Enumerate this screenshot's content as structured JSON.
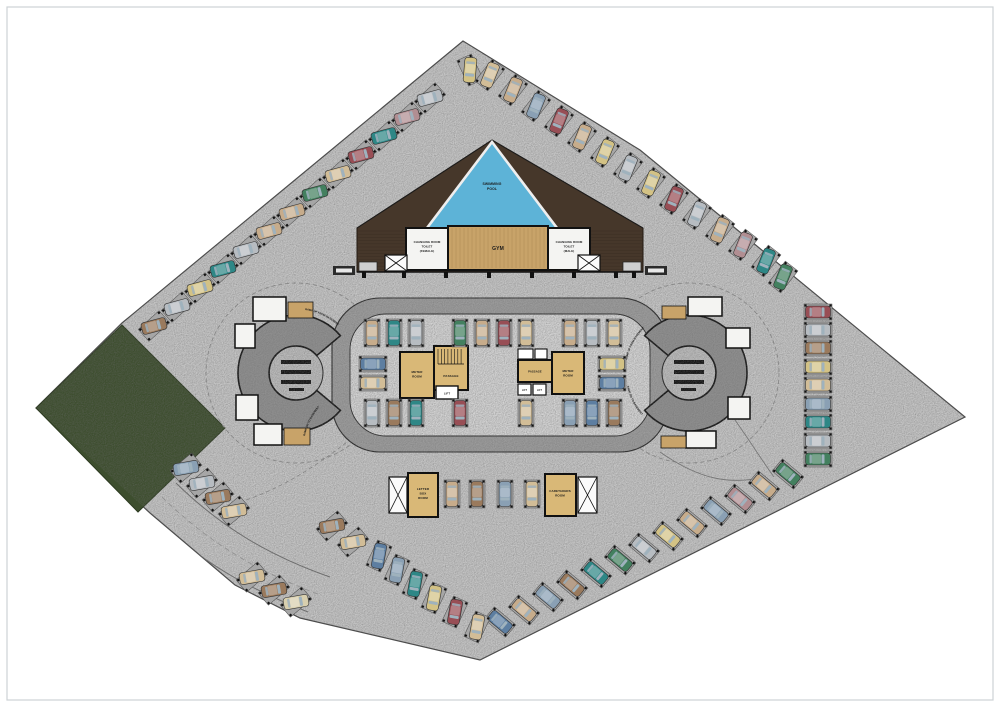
{
  "page": {
    "background": "#ffffff",
    "frame_color": "#cdd2d6"
  },
  "plan": {
    "labels": {
      "pool": [
        "SWIMMING",
        "POOL"
      ],
      "gym": "GYM",
      "changing_female": [
        "CHANGING ROOM",
        "TOILET",
        "(FEMALE)"
      ],
      "changing_male": [
        "CHANGING ROOM",
        "TOILET",
        "(MALE)"
      ],
      "meter": [
        "METER",
        "ROOM"
      ],
      "passage": "PASSAGE",
      "lift": "LIFT",
      "letter_box": [
        "LETTER",
        "BOX",
        "ROOM"
      ],
      "caretakers": [
        "CARETAKERS",
        "ROOM"
      ],
      "ramp_up": "RAMP UP FROM BASEMENT",
      "ramp_dn": "RAMP DN TO BASEMENT"
    },
    "colors": {
      "paving": "#c6c6c6",
      "road": "#9c9c9c",
      "island": "#d4d4d4",
      "ramp": "#8f8f8f",
      "ramp_core": "#bcbcbc",
      "lawn": "#3d4e2e",
      "pool": "#5db3d7",
      "wood": "#46372a",
      "gym_floor": "#c8a369",
      "core_floor": "#d9b877",
      "room_white": "#f4f4f2",
      "stall": "#a6a6a6",
      "wall": "#111111"
    },
    "car_palette": {
      "be": "#c7ac8b",
      "sa": "#d2bd97",
      "si": "#b7bcc1",
      "gy": "#9aa1a7",
      "te": "#2e8786",
      "gr": "#43805f",
      "ye": "#d3c285",
      "ma": "#984e55",
      "mv": "#b18e92",
      "br": "#9a7a5d",
      "st": "#8aa0b4",
      "nv": "#5d7ea1",
      "cr": "#d8cfae",
      "wh": "#dcdcda"
    },
    "cars": [
      {
        "x": 470,
        "y": 70,
        "a": 95,
        "p": 65,
        "c": "ye"
      },
      {
        "x": 430,
        "y": 98,
        "a": -15,
        "p": -42,
        "c": "si"
      },
      {
        "x": 407,
        "y": 117,
        "a": -15,
        "p": -42,
        "c": "mv"
      },
      {
        "x": 384,
        "y": 136,
        "a": -15,
        "p": -42,
        "c": "te"
      },
      {
        "x": 361,
        "y": 155,
        "a": -15,
        "p": -42,
        "c": "ma"
      },
      {
        "x": 338,
        "y": 174,
        "a": -15,
        "p": -42,
        "c": "sa"
      },
      {
        "x": 315,
        "y": 193,
        "a": -15,
        "p": -42,
        "c": "gr"
      },
      {
        "x": 292,
        "y": 212,
        "a": -15,
        "p": -42,
        "c": "be"
      },
      {
        "x": 269,
        "y": 231,
        "a": -15,
        "p": -42,
        "c": "be"
      },
      {
        "x": 246,
        "y": 250,
        "a": -15,
        "p": -42,
        "c": "si"
      },
      {
        "x": 223,
        "y": 269,
        "a": -15,
        "p": -42,
        "c": "te"
      },
      {
        "x": 200,
        "y": 288,
        "a": -15,
        "p": -42,
        "c": "ye"
      },
      {
        "x": 177,
        "y": 307,
        "a": -15,
        "p": -42,
        "c": "si"
      },
      {
        "x": 154,
        "y": 326,
        "a": -15,
        "p": -42,
        "c": "br"
      },
      {
        "x": 490,
        "y": 75,
        "a": 112,
        "p": 128,
        "c": "sa"
      },
      {
        "x": 513,
        "y": 90,
        "a": 112,
        "p": 128,
        "c": "be"
      },
      {
        "x": 536,
        "y": 106,
        "a": 112,
        "p": 128,
        "c": "st"
      },
      {
        "x": 559,
        "y": 121,
        "a": 112,
        "p": 128,
        "c": "ma"
      },
      {
        "x": 582,
        "y": 137,
        "a": 112,
        "p": 128,
        "c": "be"
      },
      {
        "x": 605,
        "y": 152,
        "a": 112,
        "p": 128,
        "c": "ye"
      },
      {
        "x": 628,
        "y": 168,
        "a": 112,
        "p": 128,
        "c": "si"
      },
      {
        "x": 651,
        "y": 183,
        "a": 112,
        "p": 128,
        "c": "ye"
      },
      {
        "x": 674,
        "y": 199,
        "a": 112,
        "p": 128,
        "c": "ma"
      },
      {
        "x": 697,
        "y": 214,
        "a": 112,
        "p": 128,
        "c": "si"
      },
      {
        "x": 720,
        "y": 230,
        "a": 112,
        "p": 128,
        "c": "be"
      },
      {
        "x": 743,
        "y": 245,
        "a": 112,
        "p": 128,
        "c": "mv"
      },
      {
        "x": 766,
        "y": 261,
        "a": 112,
        "p": 128,
        "c": "te"
      },
      {
        "x": 783,
        "y": 277,
        "a": 112,
        "p": 128,
        "c": "gr"
      },
      {
        "x": 818,
        "y": 312,
        "a": 0,
        "p": 0,
        "c": "ma"
      },
      {
        "x": 818,
        "y": 330,
        "a": 0,
        "p": 0,
        "c": "si"
      },
      {
        "x": 818,
        "y": 348,
        "a": 0,
        "p": 0,
        "c": "br"
      },
      {
        "x": 818,
        "y": 367,
        "a": 0,
        "p": 0,
        "c": "ye"
      },
      {
        "x": 818,
        "y": 385,
        "a": 0,
        "p": 0,
        "c": "sa"
      },
      {
        "x": 818,
        "y": 404,
        "a": 0,
        "p": 0,
        "c": "st"
      },
      {
        "x": 818,
        "y": 422,
        "a": 0,
        "p": 0,
        "c": "te"
      },
      {
        "x": 818,
        "y": 441,
        "a": 0,
        "p": 0,
        "c": "si"
      },
      {
        "x": 818,
        "y": 459,
        "a": 0,
        "p": 0,
        "c": "gr"
      },
      {
        "x": 500,
        "y": 622,
        "a": 40,
        "p": 40,
        "c": "nv"
      },
      {
        "x": 524,
        "y": 610,
        "a": 40,
        "p": 40,
        "c": "be"
      },
      {
        "x": 548,
        "y": 597,
        "a": 40,
        "p": 40,
        "c": "st"
      },
      {
        "x": 572,
        "y": 585,
        "a": 40,
        "p": 40,
        "c": "br"
      },
      {
        "x": 596,
        "y": 573,
        "a": 40,
        "p": 40,
        "c": "te"
      },
      {
        "x": 620,
        "y": 560,
        "a": 40,
        "p": 40,
        "c": "gr"
      },
      {
        "x": 644,
        "y": 548,
        "a": 40,
        "p": 40,
        "c": "si"
      },
      {
        "x": 668,
        "y": 536,
        "a": 40,
        "p": 40,
        "c": "ye"
      },
      {
        "x": 692,
        "y": 523,
        "a": 40,
        "p": 40,
        "c": "be"
      },
      {
        "x": 716,
        "y": 511,
        "a": 40,
        "p": 40,
        "c": "st"
      },
      {
        "x": 740,
        "y": 499,
        "a": 40,
        "p": 40,
        "c": "mv"
      },
      {
        "x": 764,
        "y": 486,
        "a": 40,
        "p": 40,
        "c": "be"
      },
      {
        "x": 788,
        "y": 474,
        "a": 40,
        "p": 40,
        "c": "gr"
      },
      {
        "x": 379,
        "y": 556,
        "a": 100,
        "p": 115,
        "c": "nv"
      },
      {
        "x": 397,
        "y": 570,
        "a": 100,
        "p": 115,
        "c": "st"
      },
      {
        "x": 415,
        "y": 584,
        "a": 100,
        "p": 115,
        "c": "te"
      },
      {
        "x": 434,
        "y": 598,
        "a": 100,
        "p": 115,
        "c": "ye"
      },
      {
        "x": 455,
        "y": 612,
        "a": 100,
        "p": 115,
        "c": "ma"
      },
      {
        "x": 477,
        "y": 627,
        "a": 100,
        "p": 115,
        "c": "sa"
      },
      {
        "x": 252,
        "y": 577,
        "a": -10,
        "p": -40,
        "c": "sa"
      },
      {
        "x": 274,
        "y": 590,
        "a": -10,
        "p": -40,
        "c": "br"
      },
      {
        "x": 296,
        "y": 602,
        "a": -10,
        "p": -40,
        "c": "cr"
      },
      {
        "x": 332,
        "y": 526,
        "a": -10,
        "p": -40,
        "c": "br"
      },
      {
        "x": 353,
        "y": 542,
        "a": -10,
        "p": -40,
        "c": "sa"
      },
      {
        "x": 186,
        "y": 468,
        "a": -10,
        "p": -40,
        "c": "st"
      },
      {
        "x": 202,
        "y": 483,
        "a": -10,
        "p": -40,
        "c": "si"
      },
      {
        "x": 218,
        "y": 497,
        "a": -10,
        "p": -40,
        "c": "br"
      },
      {
        "x": 234,
        "y": 511,
        "a": -10,
        "p": -40,
        "c": "sa"
      },
      {
        "x": 372,
        "y": 333,
        "a": 90,
        "p": 90,
        "c": "be"
      },
      {
        "x": 394,
        "y": 333,
        "a": 90,
        "p": 90,
        "c": "te"
      },
      {
        "x": 416,
        "y": 333,
        "a": 90,
        "p": 90,
        "c": "si"
      },
      {
        "x": 460,
        "y": 333,
        "a": 90,
        "p": 90,
        "c": "gr"
      },
      {
        "x": 482,
        "y": 333,
        "a": 90,
        "p": 90,
        "c": "be"
      },
      {
        "x": 504,
        "y": 333,
        "a": 90,
        "p": 90,
        "c": "ma"
      },
      {
        "x": 526,
        "y": 333,
        "a": 90,
        "p": 90,
        "c": "sa"
      },
      {
        "x": 570,
        "y": 333,
        "a": 90,
        "p": 90,
        "c": "be"
      },
      {
        "x": 592,
        "y": 333,
        "a": 90,
        "p": 90,
        "c": "si"
      },
      {
        "x": 614,
        "y": 333,
        "a": 90,
        "p": 90,
        "c": "sa"
      },
      {
        "x": 372,
        "y": 413,
        "a": 90,
        "p": 90,
        "c": "si"
      },
      {
        "x": 394,
        "y": 413,
        "a": 90,
        "p": 90,
        "c": "br"
      },
      {
        "x": 416,
        "y": 413,
        "a": 90,
        "p": 90,
        "c": "te"
      },
      {
        "x": 460,
        "y": 413,
        "a": 90,
        "p": 90,
        "c": "ma"
      },
      {
        "x": 526,
        "y": 413,
        "a": 90,
        "p": 90,
        "c": "sa"
      },
      {
        "x": 570,
        "y": 413,
        "a": 90,
        "p": 90,
        "c": "st"
      },
      {
        "x": 592,
        "y": 413,
        "a": 90,
        "p": 90,
        "c": "nv"
      },
      {
        "x": 614,
        "y": 413,
        "a": 90,
        "p": 90,
        "c": "br"
      },
      {
        "x": 373,
        "y": 364,
        "a": 0,
        "p": 0,
        "c": "nv"
      },
      {
        "x": 373,
        "y": 383,
        "a": 0,
        "p": 0,
        "c": "sa"
      },
      {
        "x": 612,
        "y": 364,
        "a": 0,
        "p": 0,
        "c": "ye"
      },
      {
        "x": 612,
        "y": 383,
        "a": 0,
        "p": 0,
        "c": "nv"
      },
      {
        "x": 452,
        "y": 494,
        "a": 90,
        "p": 90,
        "c": "be"
      },
      {
        "x": 477,
        "y": 494,
        "a": 90,
        "p": 90,
        "c": "br"
      },
      {
        "x": 505,
        "y": 494,
        "a": 90,
        "p": 90,
        "c": "st"
      },
      {
        "x": 532,
        "y": 494,
        "a": 90,
        "p": 90,
        "c": "sa"
      }
    ]
  }
}
